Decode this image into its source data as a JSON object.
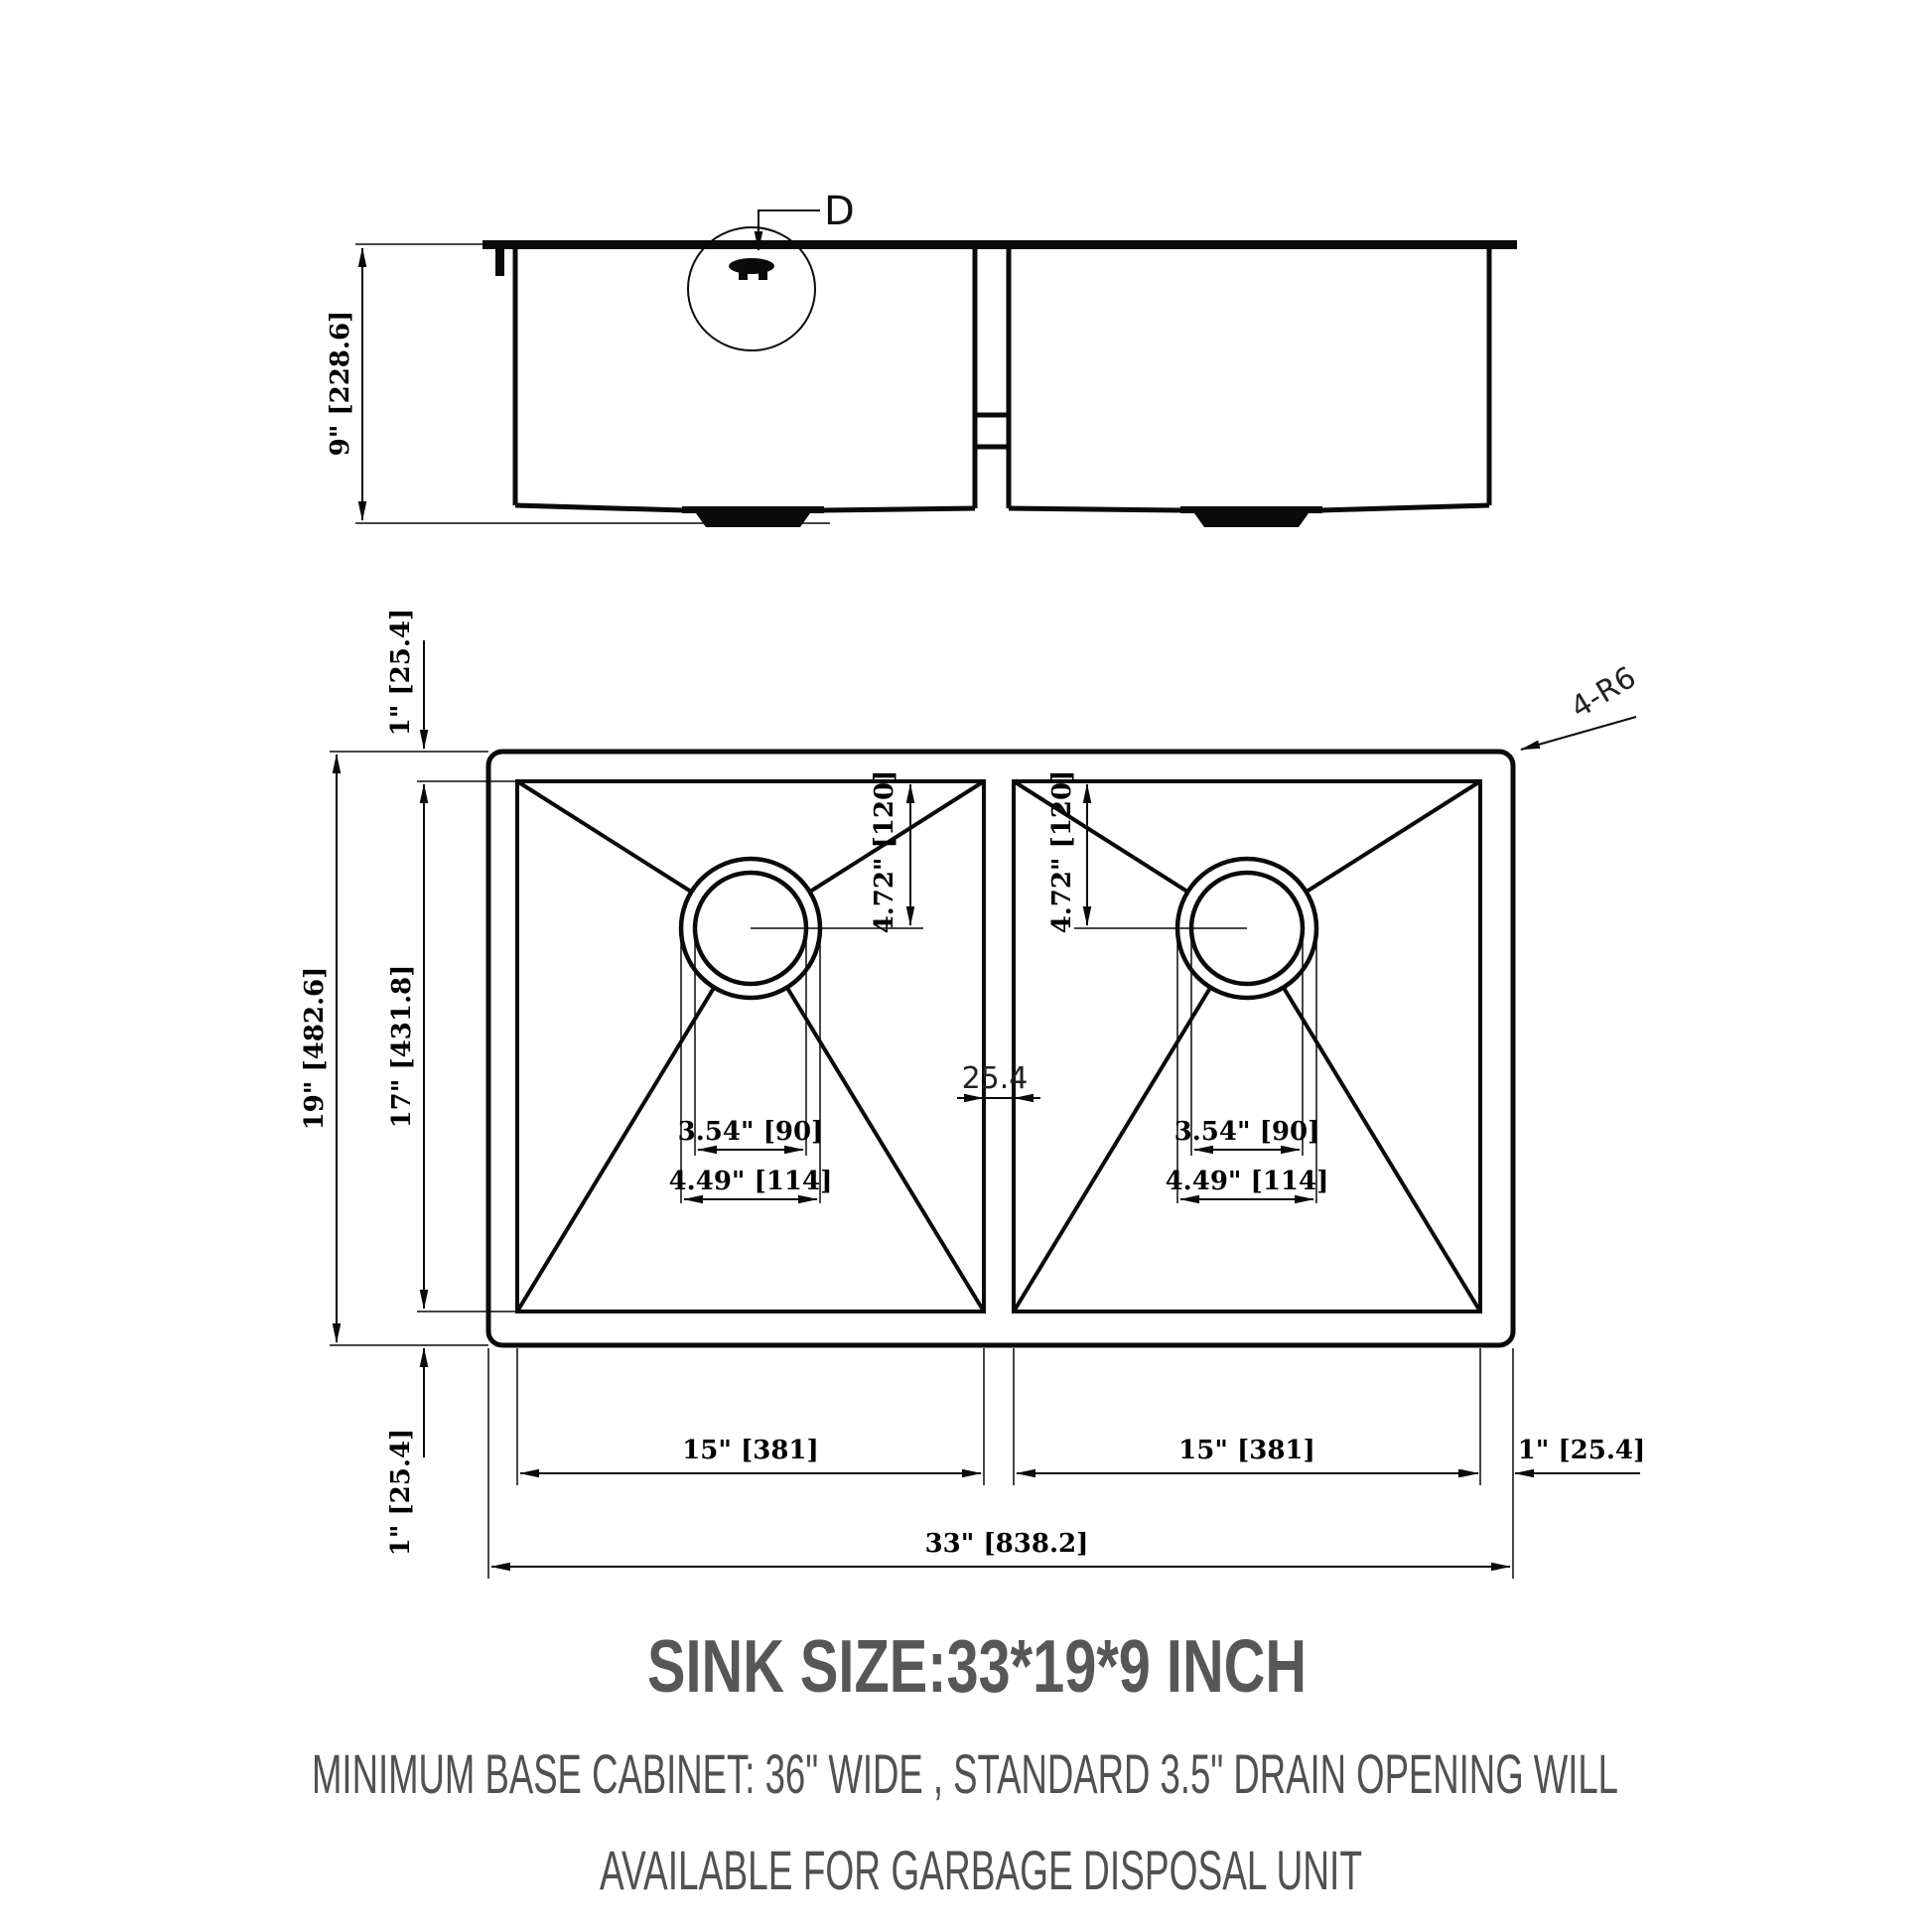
{
  "drawing": {
    "detail_label": "D",
    "corner_callout": "4-R6",
    "divider_mm": "25.4",
    "side": {
      "height": "9\" [228.6]"
    },
    "plan": {
      "outer_depth": "19\" [482.6]",
      "bowl_depth": "17\" [431.8]",
      "rim_top": "1\" [25.4]",
      "rim_bottom": "1\" [25.4]",
      "rim_right": "1\" [25.4]",
      "overall_width": "33\" [838.2]",
      "left_bowl": {
        "width": "15\" [381]",
        "drain_from_top": "4.72\" [120]",
        "drain_inner": "3.54\" [90]",
        "drain_outer": "4.49\" [114]"
      },
      "right_bowl": {
        "width": "15\" [381]",
        "drain_from_top": "4.72\" [120]",
        "drain_inner": "3.54\" [90]",
        "drain_outer": "4.49\" [114]"
      }
    }
  },
  "footer": {
    "title": "SINK SIZE:33*19*9 INCH",
    "note_line1": "MINIMUM BASE CABINET: 36\" WIDE , STANDARD 3.5\" DRAIN OPENING WILL",
    "note_line2": "AVAILABLE FOR GARBAGE DISPOSAL UNIT"
  }
}
